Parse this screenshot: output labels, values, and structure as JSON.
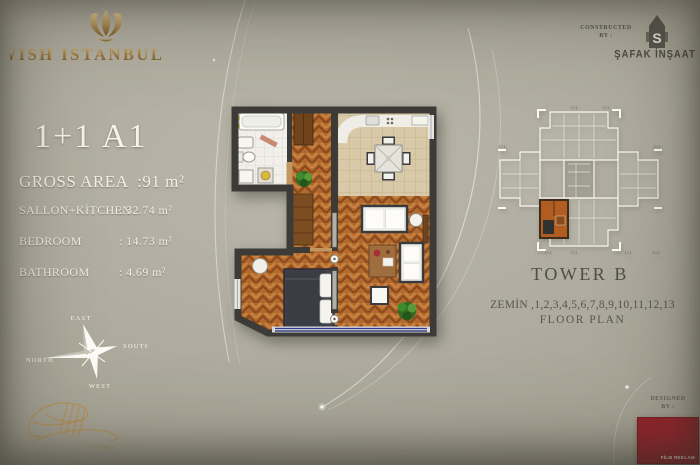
{
  "brand": {
    "name": "WISH ISTANBUL"
  },
  "unit": {
    "title": "1+1 A1",
    "gross_area": {
      "label": "GROSS AREA",
      "value": ":91 m²"
    },
    "rooms": [
      {
        "label": "SALLON+KİTCHEN",
        "value": ": 32.74 m²"
      },
      {
        "label": "BEDROOM",
        "value": ": 14.73 m²"
      },
      {
        "label": "BATHROOM",
        "value": ": 4.69  m²"
      }
    ]
  },
  "constructed_by": {
    "line1": "CONSTRUCTED",
    "line2": "BY :",
    "company": "ŞAFAK İNŞAAT",
    "logo_letter": "S"
  },
  "tower": {
    "name": "TOWER B",
    "floors": "ZEMİN ,1,2,3,4,5,6,7,8,9,10,11,12,13",
    "plan_label": "FLOOR PLAN",
    "key_unit_label": "1+1"
  },
  "compass": {
    "top": "EAST",
    "right": "SOUTH",
    "left": "NORTH",
    "bottom": "WEST"
  },
  "signature": {
    "date": "15/10/2014"
  },
  "designed_by": {
    "line1": "DESIGNED",
    "line2": "BY :",
    "logo_text": "FİLM REKLAM"
  },
  "colors": {
    "background": "#aba89b",
    "gold": "#a5803f",
    "wall": "#3d3b37",
    "parquet": "#b2692e",
    "accent_red": "#95232b",
    "window_blue": "#2b3a8c"
  }
}
